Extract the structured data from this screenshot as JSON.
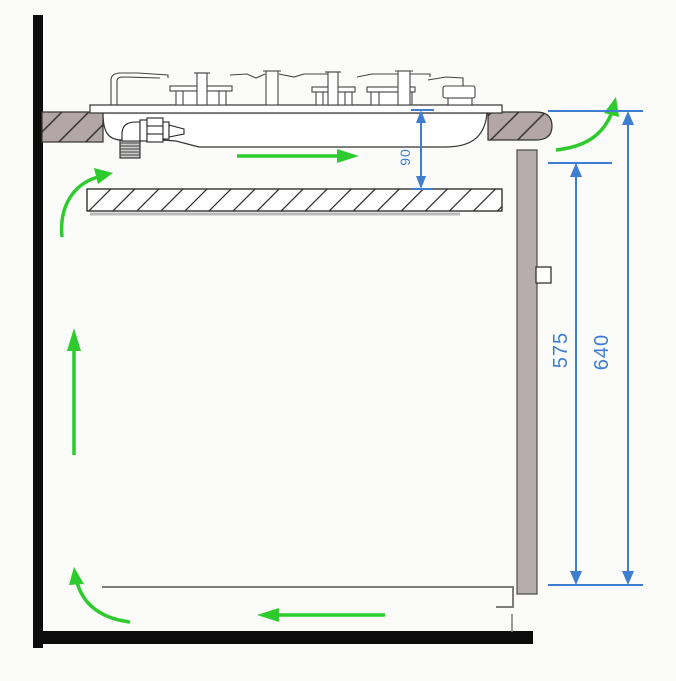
{
  "diagram": {
    "type": "gas-hob-installation-cross-section",
    "dimensions": {
      "hob_to_shelf": "90",
      "panel_clearance": "575",
      "overall_clearance": "640"
    },
    "colors": {
      "dimension_blue": "#3d7ed2",
      "airflow_green": "#2dcb2d",
      "countertop_fill": "#b2a6a6",
      "panel_fill": "#b7adaf",
      "wall_floor_black": "#0c0c0c"
    },
    "airflow_arrows": [
      {
        "name": "cabinet-front-up-arrow",
        "direction": "curved-up-right"
      },
      {
        "name": "under-hob-arrow",
        "direction": "right"
      },
      {
        "name": "behind-panel-exit-arrow",
        "direction": "curved-up"
      },
      {
        "name": "cabinet-interior-up-arrow",
        "direction": "up"
      },
      {
        "name": "cabinet-bottom-arrow",
        "direction": "left"
      },
      {
        "name": "toe-kick-inlet-arrow",
        "direction": "curved-up"
      }
    ]
  }
}
